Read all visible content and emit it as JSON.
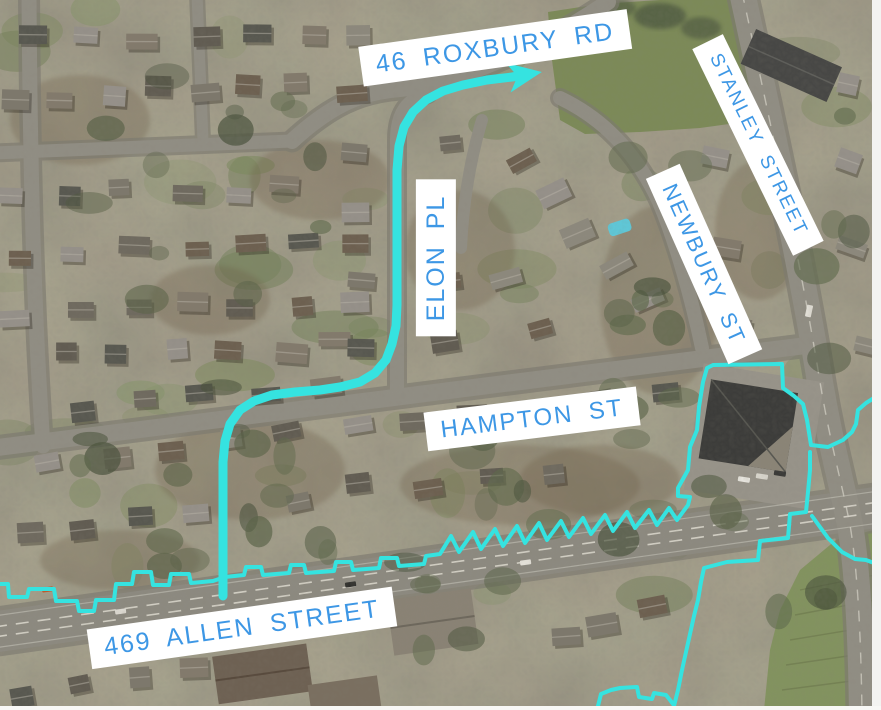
{
  "map": {
    "labels": [
      {
        "text": "46 ROXBURY RD",
        "x": 495,
        "y": 48,
        "rotation": -8,
        "font_size": 25
      },
      {
        "text": "STANLEY STREET",
        "x": 758,
        "y": 145,
        "rotation": 64,
        "font_size": 19
      },
      {
        "text": "ELON PL",
        "x": 436,
        "y": 258,
        "rotation": -90,
        "font_size": 25
      },
      {
        "text": "NEWBURY ST",
        "x": 704,
        "y": 264,
        "rotation": 66,
        "font_size": 22
      },
      {
        "text": "HAMPTON ST",
        "x": 532,
        "y": 419,
        "rotation": -7,
        "font_size": 24
      },
      {
        "text": "469 ALLEN STREET",
        "x": 242,
        "y": 628,
        "rotation": -8,
        "font_size": 25
      }
    ],
    "colors": {
      "annotation_cyan": "#35E3E0",
      "label_text": "#3D97E5",
      "label_background": "#FFFFFF"
    },
    "route": {
      "stroke_width": 9,
      "has_arrowhead": true,
      "points": [
        [
          223,
          596
        ],
        [
          223,
          500
        ],
        [
          223,
          462
        ],
        [
          225,
          441
        ],
        [
          230,
          424
        ],
        [
          240,
          410
        ],
        [
          254,
          401
        ],
        [
          272,
          395
        ],
        [
          295,
          392
        ],
        [
          320,
          390
        ],
        [
          340,
          387
        ],
        [
          360,
          382
        ],
        [
          375,
          373
        ],
        [
          386,
          360
        ],
        [
          392,
          344
        ],
        [
          396,
          326
        ],
        [
          397,
          305
        ],
        [
          397,
          210
        ],
        [
          397,
          170
        ],
        [
          399,
          146
        ],
        [
          404,
          127
        ],
        [
          413,
          112
        ],
        [
          426,
          100
        ],
        [
          443,
          91
        ],
        [
          463,
          85
        ],
        [
          487,
          80
        ],
        [
          512,
          77
        ],
        [
          530,
          74
        ]
      ]
    },
    "boundaries": [
      [
        [
          0,
          584
        ],
        [
          8,
          584
        ],
        [
          9,
          597
        ],
        [
          27,
          597
        ],
        [
          29,
          589
        ],
        [
          54,
          589
        ],
        [
          56,
          601
        ],
        [
          77,
          601
        ],
        [
          79,
          611
        ],
        [
          94,
          611
        ],
        [
          96,
          600
        ],
        [
          114,
          600
        ],
        [
          116,
          584
        ],
        [
          132,
          584
        ],
        [
          134,
          572
        ],
        [
          151,
          572
        ],
        [
          153,
          585
        ],
        [
          169,
          585
        ],
        [
          171,
          574
        ],
        [
          189,
          574
        ],
        [
          191,
          583
        ],
        [
          213,
          581
        ],
        [
          225,
          577
        ],
        [
          244,
          575
        ],
        [
          246,
          567
        ],
        [
          261,
          567
        ],
        [
          263,
          575
        ],
        [
          289,
          573
        ],
        [
          291,
          565
        ],
        [
          304,
          565
        ],
        [
          306,
          573
        ],
        [
          334,
          571
        ],
        [
          336,
          562
        ],
        [
          351,
          562
        ],
        [
          353,
          570
        ],
        [
          379,
          568
        ],
        [
          381,
          558
        ],
        [
          397,
          558
        ],
        [
          399,
          566
        ],
        [
          424,
          564
        ],
        [
          426,
          556
        ],
        [
          440,
          554
        ],
        [
          451,
          536
        ],
        [
          459,
          552
        ],
        [
          473,
          532
        ],
        [
          481,
          549
        ],
        [
          495,
          529
        ],
        [
          503,
          546
        ],
        [
          517,
          526
        ],
        [
          525,
          543
        ],
        [
          539,
          523
        ],
        [
          547,
          540
        ],
        [
          561,
          521
        ],
        [
          569,
          537
        ],
        [
          583,
          518
        ],
        [
          591,
          534
        ],
        [
          605,
          515
        ],
        [
          613,
          531
        ],
        [
          627,
          512
        ],
        [
          635,
          528
        ],
        [
          649,
          510
        ],
        [
          657,
          525
        ],
        [
          669,
          508
        ],
        [
          677,
          520
        ],
        [
          688,
          505
        ],
        [
          690,
          497
        ],
        [
          678,
          496
        ],
        [
          678,
          488
        ],
        [
          688,
          470
        ],
        [
          690,
          447
        ],
        [
          697,
          430
        ],
        [
          699,
          407
        ],
        [
          703,
          382
        ],
        [
          707,
          368
        ],
        [
          713,
          365
        ],
        [
          782,
          364
        ],
        [
          783,
          388
        ],
        [
          794,
          396
        ],
        [
          803,
          404
        ],
        [
          807,
          420
        ],
        [
          811,
          445
        ],
        [
          828,
          447
        ],
        [
          843,
          440
        ],
        [
          852,
          432
        ],
        [
          856,
          424
        ],
        [
          858,
          410
        ],
        [
          866,
          403
        ],
        [
          874,
          398
        ],
        [
          881,
          396
        ]
      ],
      [
        [
          810,
          452
        ],
        [
          810,
          470
        ],
        [
          808,
          492
        ],
        [
          806,
          512
        ],
        [
          790,
          514
        ],
        [
          788,
          538
        ],
        [
          760,
          541
        ],
        [
          758,
          560
        ],
        [
          727,
          562
        ],
        [
          704,
          568
        ],
        [
          701,
          582
        ],
        [
          698,
          600
        ],
        [
          694,
          616
        ],
        [
          690,
          634
        ],
        [
          686,
          652
        ],
        [
          682,
          670
        ],
        [
          678,
          690
        ],
        [
          673,
          710
        ]
      ],
      [
        [
          597,
          710
        ],
        [
          601,
          694
        ],
        [
          611,
          690
        ],
        [
          620,
          688
        ],
        [
          637,
          687
        ],
        [
          639,
          697
        ],
        [
          652,
          699
        ],
        [
          654,
          693
        ],
        [
          666,
          695
        ],
        [
          670,
          700
        ],
        [
          673,
          704
        ]
      ],
      [
        [
          812,
          516
        ],
        [
          828,
          538
        ],
        [
          842,
          552
        ],
        [
          855,
          559
        ],
        [
          866,
          560
        ],
        [
          874,
          563
        ],
        [
          881,
          566
        ]
      ]
    ]
  }
}
